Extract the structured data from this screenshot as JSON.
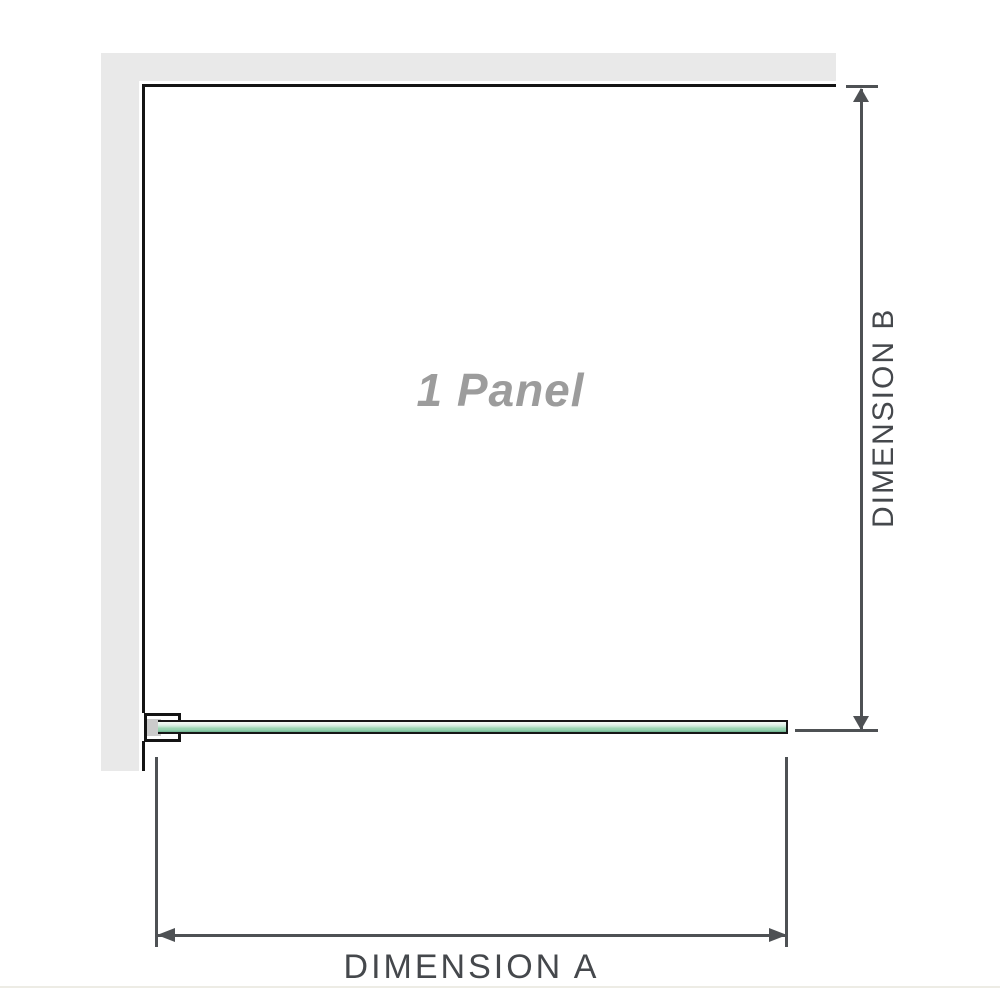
{
  "diagram": {
    "panel_label": "1 Panel",
    "dimension_a": {
      "label": "DIMENSION A"
    },
    "dimension_b": {
      "label": "DIMENSION B"
    },
    "colors": {
      "wall": "#e9e9e9",
      "outline": "#141414",
      "dimension_line": "#4e5154",
      "dimension_text": "#45484c",
      "panel_label_text": "#9c9c9c",
      "glass_green_light": "#f3faf5",
      "glass_green": "#9ed6b4",
      "glass_green_dark": "#6db08d",
      "bracket_pad": "#cbcbcb"
    }
  }
}
